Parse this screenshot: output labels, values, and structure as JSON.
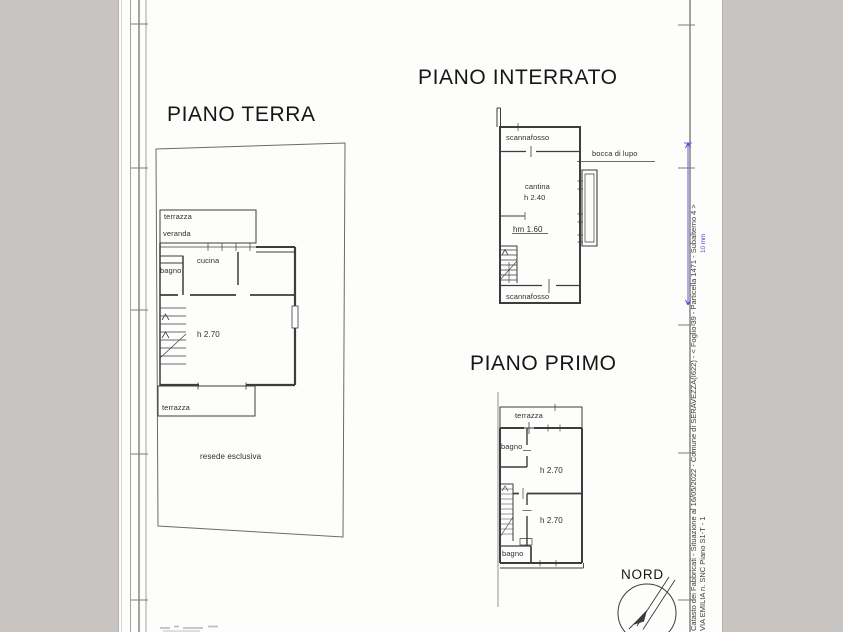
{
  "colors": {
    "background": "#c7c4c1",
    "paper": "#fdfdfc",
    "ink": "#3d3d3d",
    "accent_blue": "#4747c9"
  },
  "plans": {
    "piano_terra": {
      "title": "PIANO TERRA",
      "labels": {
        "terrazza_top": "terrazza",
        "veranda": "veranda",
        "bagno": "bagno",
        "cucina": "cucina",
        "height": "h 2.70",
        "terrazza_bottom": "terrazza",
        "resede": "resede esclusiva"
      }
    },
    "piano_interrato": {
      "title": "PIANO INTERRATO",
      "labels": {
        "scannafosso_top": "scannafosso",
        "cantina": "cantina",
        "cantina_height": "h 2.40",
        "mezzanine_height": "hm 1.60",
        "scannafosso_bottom": "scannafosso",
        "bocca_di_lupo": "bocca di lupo"
      }
    },
    "piano_primo": {
      "title": "PIANO PRIMO",
      "labels": {
        "terrazza": "terrazza",
        "bagno_top": "bagno",
        "room1_height": "h 2.70",
        "room2_height": "h 2.70",
        "bagno_bottom": "bagno"
      }
    }
  },
  "compass": {
    "label": "NORD"
  },
  "margin": {
    "line1": "Catasto dei Fabbricati - Situazione al 16/05/2022 - Comune di SERAVEZZA(I622) - < Foglio 39 - Particella  1471 - Subalterno 4 >",
    "line2": "VIA EMILIA n. SNC Piano S1-T - 1",
    "dimension_label": "10 mm"
  }
}
